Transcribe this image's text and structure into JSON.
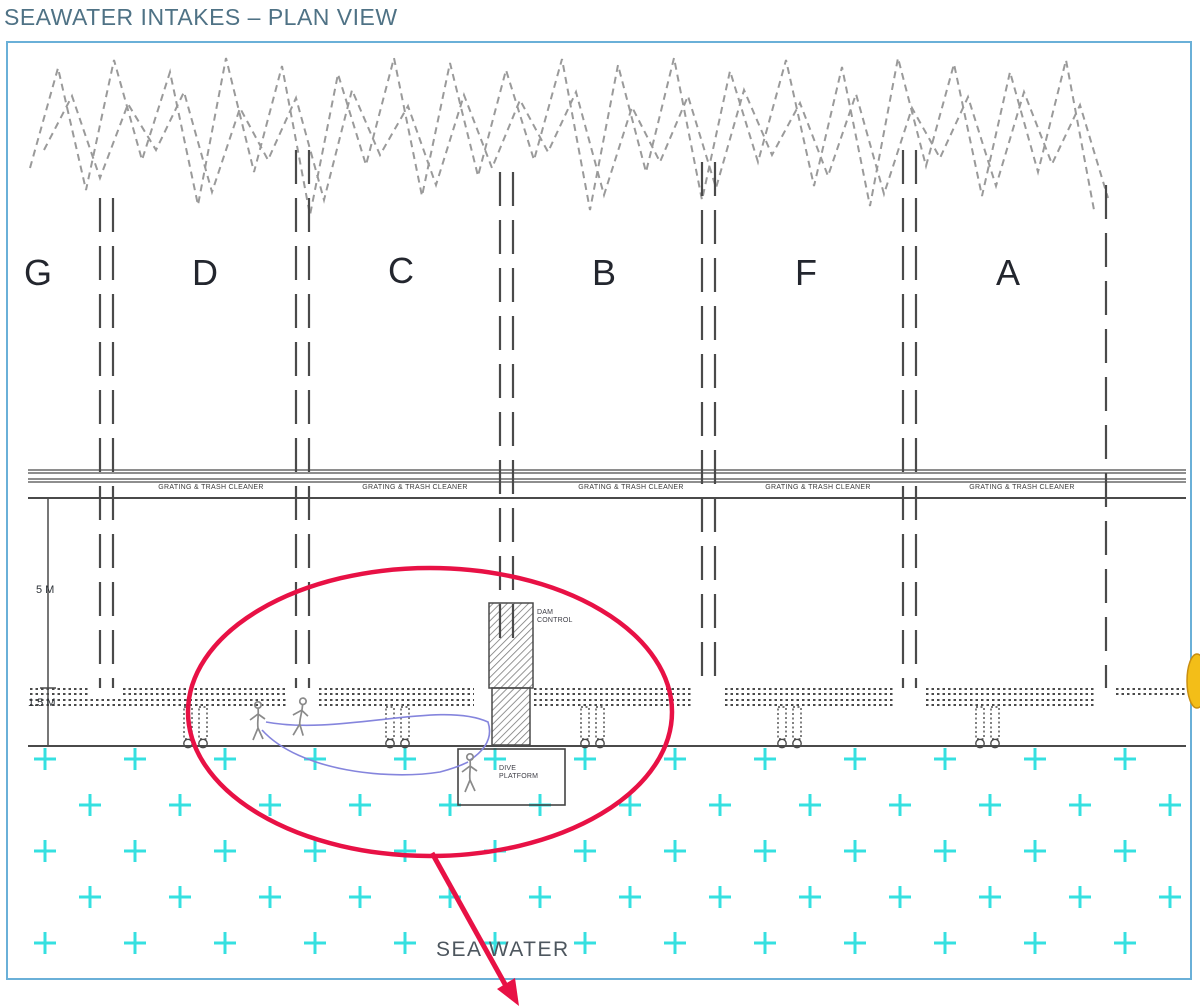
{
  "title": "SEAWATER INTAKES – PLAN VIEW",
  "bays": [
    "G",
    "D",
    "C",
    "B",
    "F",
    "A"
  ],
  "labels": {
    "grating": "GRATING & TRASH CLEANER",
    "sea_water": "SEA WATER"
  },
  "dimensions": {
    "depth": "5 M",
    "grating_depth": "1.5 M"
  },
  "callouts": {
    "dam_control": {
      "line1": "DAM",
      "line2": "CONTROL"
    },
    "dive_platform": {
      "line1": "DIVE",
      "line2": "PLATFORM"
    }
  },
  "colors": {
    "accent_red": "#E81145",
    "water_cyan": "#35E0E0",
    "frame_blue": "#6AB0D8",
    "title_color": "#4F7285",
    "line_color": "#4A4A4A",
    "highlight_yellow": "#F3BE18"
  }
}
